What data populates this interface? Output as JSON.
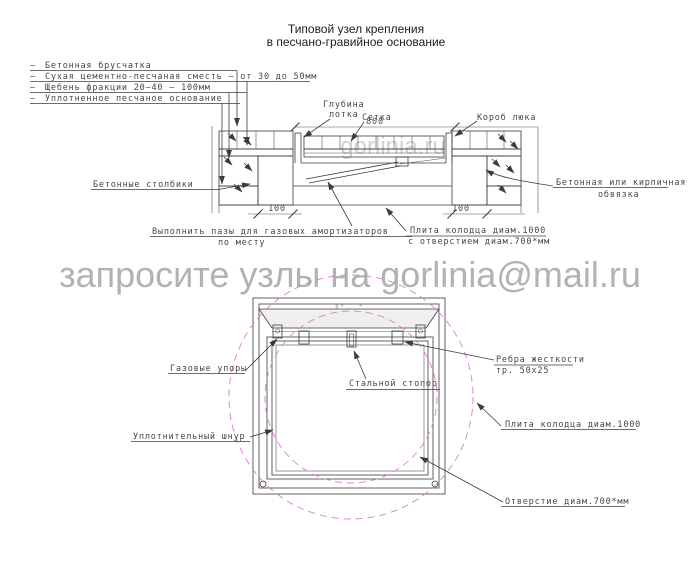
{
  "title": {
    "line1": "Типовой узел крепления",
    "line2": "в песчано-гравийное основание"
  },
  "legend": {
    "bullet": "—",
    "items": [
      {
        "label": "Бетонная брусчатка"
      },
      {
        "label": "Сухая цементно-песчаная сместь — от 30 до 50мм"
      },
      {
        "label": "Щебень фракции 20—40 — 100мм"
      },
      {
        "label": "Уплотненное песчаное основание"
      }
    ]
  },
  "section": {
    "dims": {
      "opening_width": "800",
      "pillar_left": "100",
      "pillar_right": "100"
    },
    "labels": {
      "tray_depth_line1": "Глубина",
      "tray_depth_line2": "лотка",
      "mesh": "Сетка",
      "hatch_box": "Короб люка",
      "pillars": "Бетонные столбики",
      "edging_line1": "Бетонная или кирпичная",
      "edging_line2": "обвязка",
      "grooves_line1": "Выполнить пазы для газовых амортизаторов",
      "grooves_line2": "по месту",
      "slab_line1": "Плита колодца диам.1000",
      "slab_line2": "с отверстием диам.700*мм"
    }
  },
  "plan": {
    "labels": {
      "gas_struts": "Газовые упоры",
      "steel_stop": "Стальной стопор",
      "ribs_line1": "Ребра жесткости",
      "ribs_line2": "тр. 50х25",
      "slab": "Плита колодца диам.1000",
      "seal_cord": "Уплотнительный шнур",
      "hole": "Отверстие диам.700*мм"
    }
  },
  "watermarks": {
    "request": "запросите узлы на gorlinia@mail.ru",
    "request_color": "#b2b2b2",
    "site": "gorlinia.ru",
    "site_color": "#c6c6c6",
    "site_faint_color": "#d2d2d2"
  },
  "colors": {
    "line": "#3c3c3c",
    "pink_dashed": "#dd7ad6",
    "tray_fill": "#d9d9d9",
    "channel_fill": "#efefef"
  }
}
